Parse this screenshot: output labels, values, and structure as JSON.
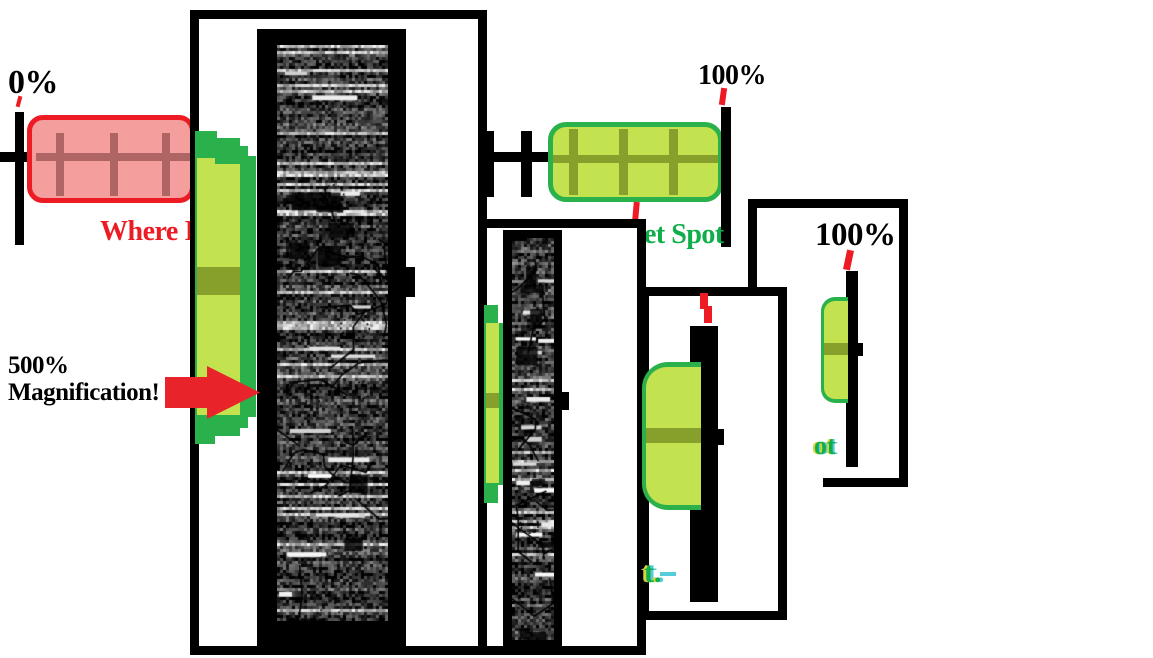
{
  "meta": {
    "description": "Hand-drawn MS-Paint style meme diagram: a progress bar sweet spot shown at 500% magnification in recursive zoom panels",
    "width": 1153,
    "height": 658
  },
  "labels": {
    "zero_percent": "0%",
    "hundred_percent_top": "100%",
    "where_label": "Where I",
    "sweet_spot_partial": "et Spot",
    "magnification": "500% Magnification!",
    "hundred_percent_panel4": "100%",
    "glitch_t": "t.",
    "glitch_ot": "ot"
  },
  "colors": {
    "red": "#ed1c24",
    "pink": "#f59e9e",
    "dark_red": "#b06565",
    "green": "#2ab14c",
    "yellow_green": "#c3e24f",
    "olive": "#86a02b",
    "spot_green": "#0fae4a",
    "glitch_cyan": "#54ccdc",
    "glitch_yellow": "#d6d23e",
    "arrow_red": "#e8232a",
    "black": "#000000",
    "white": "#ffffff"
  },
  "noise_panels": [
    {
      "w": 111,
      "h": 576,
      "seed": 7,
      "scribbles": 16,
      "ovals": 5
    },
    {
      "w": 42,
      "h": 402,
      "seed": 13,
      "scribbles": 10,
      "ovals": 3
    }
  ]
}
